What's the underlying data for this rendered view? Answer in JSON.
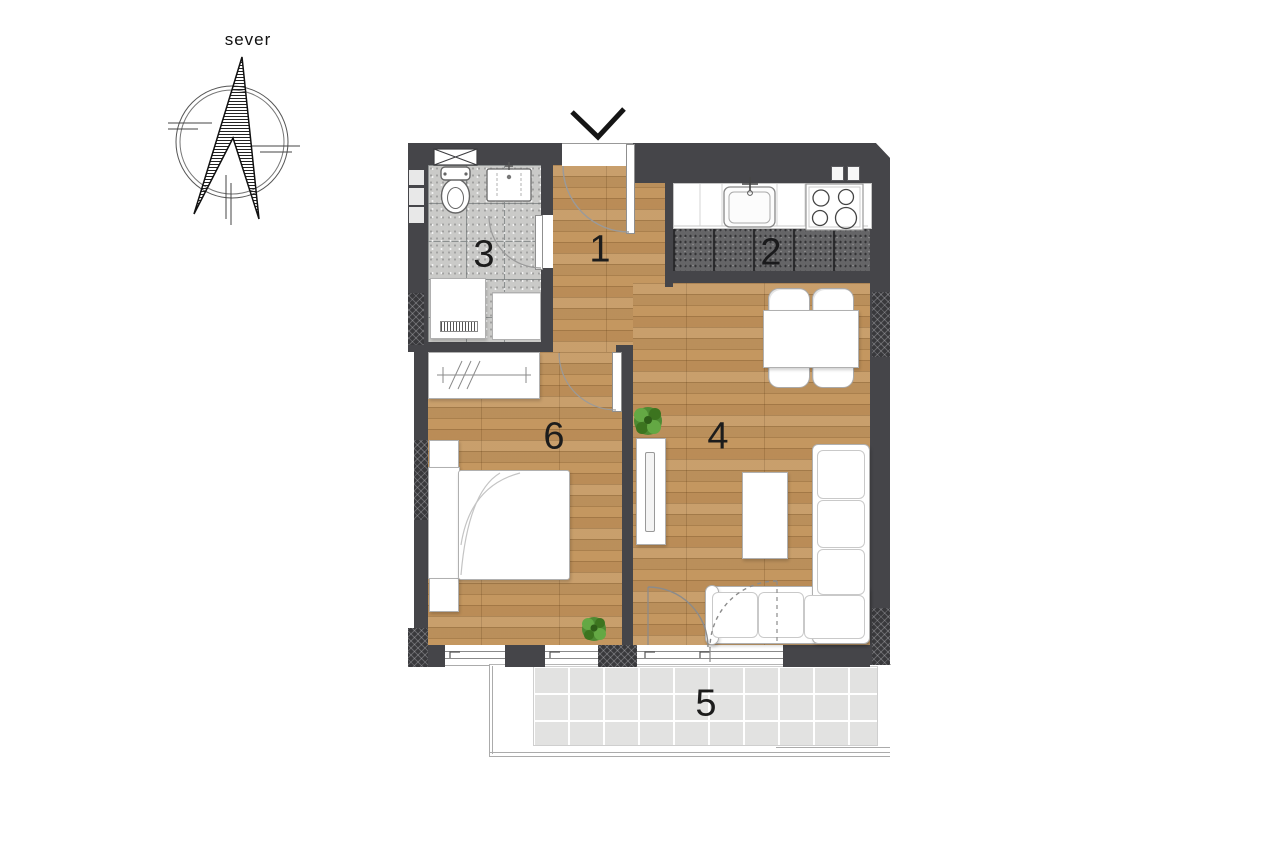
{
  "compass": {
    "label": "sever"
  },
  "entrance": {
    "marker_icon": "chevron-down-icon"
  },
  "rooms": {
    "hallway": {
      "number": "1"
    },
    "kitchen": {
      "number": "2"
    },
    "bathroom": {
      "number": "3"
    },
    "living_room": {
      "number": "4"
    },
    "balcony": {
      "number": "5"
    },
    "bedroom": {
      "number": "6"
    }
  },
  "palette": {
    "wall": "#454549",
    "wood_floor": "#c49760",
    "bathroom_tile": "#cacac8",
    "kitchen_tile": "#656567",
    "balcony_tile": "#e2e2e1",
    "plant_green": "#4e8a33",
    "label_text": "#1c1c1c"
  }
}
